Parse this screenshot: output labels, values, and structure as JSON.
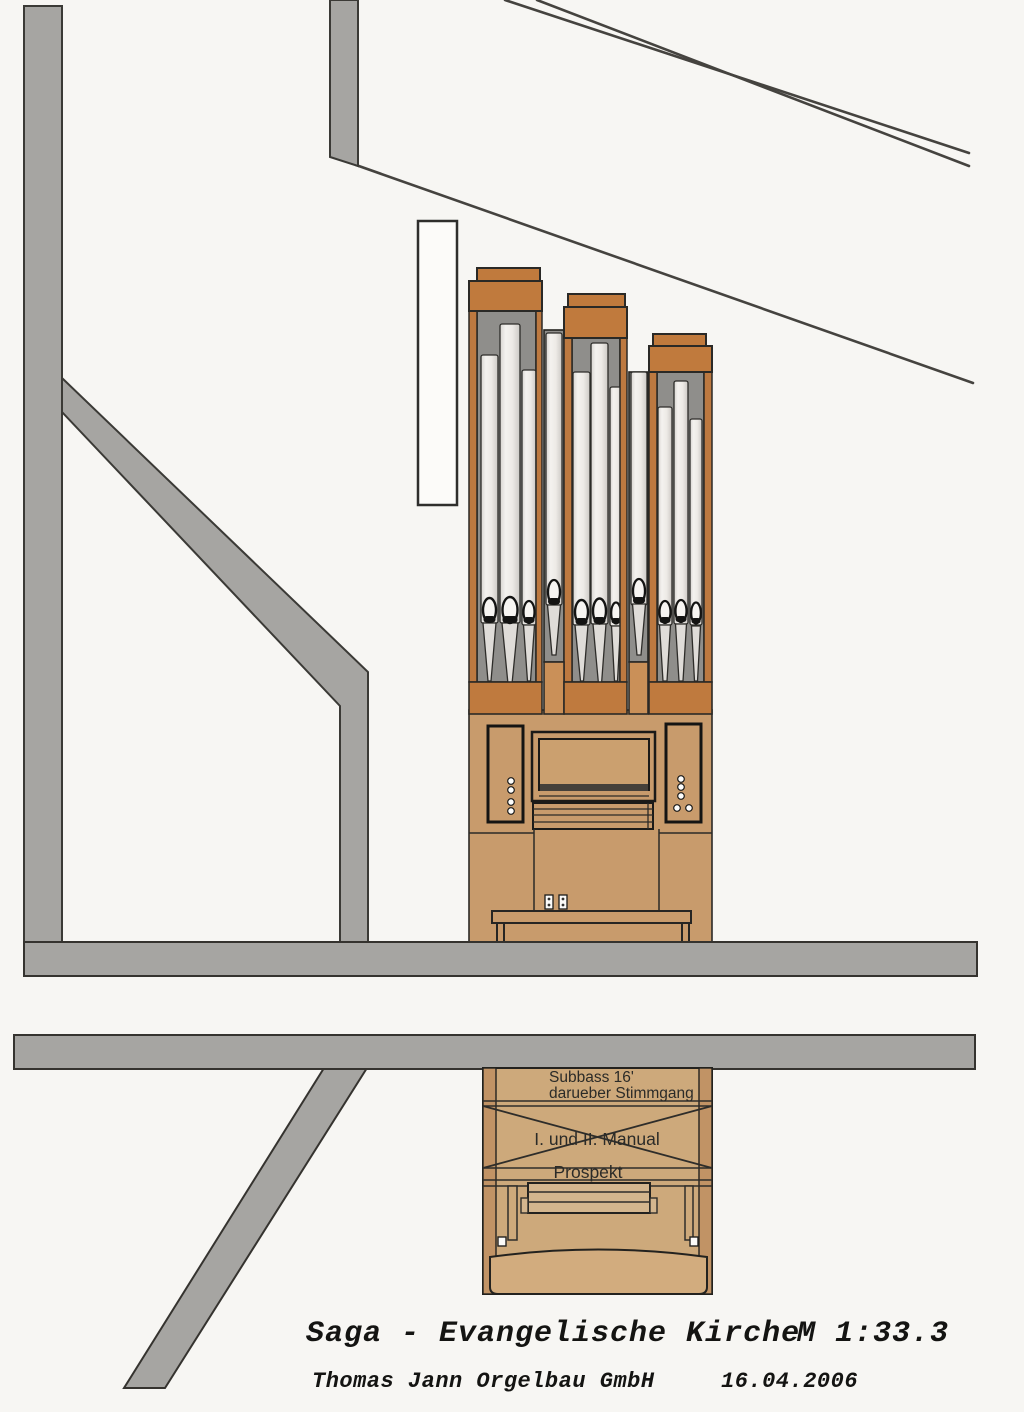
{
  "drawing": {
    "title": "Saga - Evangelische Kirche",
    "scale": "M 1:33.3",
    "company": "Thomas Jann Orgelbau GmbH",
    "date": "16.04.2006"
  },
  "organ_labels": {
    "subbass_line1": "Subbass 16'",
    "subbass_line2": "darueber Stimmgang",
    "manuals": "I. und II. Manual",
    "prospekt": "Prospekt"
  },
  "palette": {
    "paper": "#f7f6f3",
    "structure_gray": "#a6a5a2",
    "outline_dark": "#3b3a36",
    "roof_line": "#45433f",
    "case_orange": "#c07a3d",
    "case_tan": "#c89b6c",
    "case_tan_dark": "#c19365",
    "case_tan_light": "#cda97b",
    "pipe_silver": "#eeebe7",
    "pipe_background_gray": "#8f8e8b",
    "ink": "#1c1b19"
  }
}
